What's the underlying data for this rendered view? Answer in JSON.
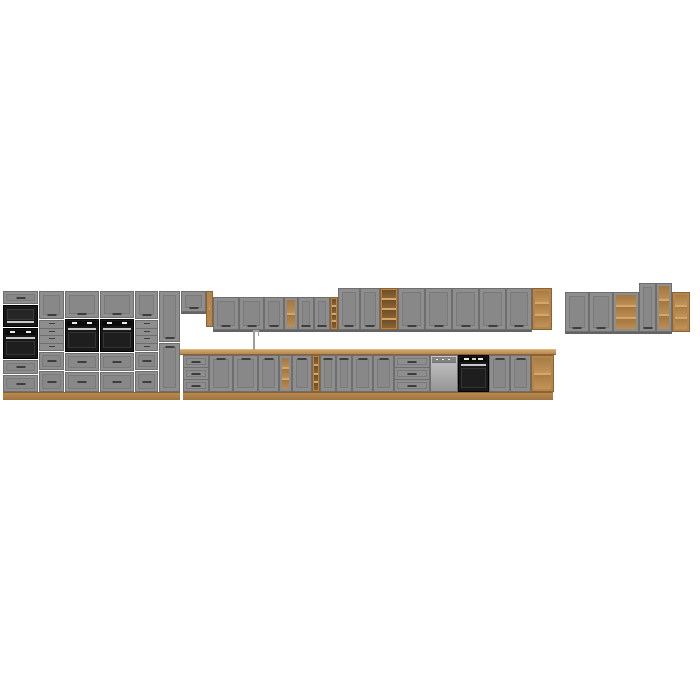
{
  "image": {
    "subject": "modular-kitchen-furniture-set-render",
    "background": "#ffffff",
    "front_style": "grey-shaker",
    "accent_material": "oak-wood"
  },
  "palette": {
    "door-gray": "#8e8e8e",
    "door-panel": "#888888",
    "door-frame": "#7a7a7a",
    "gap": "#6e6e6e",
    "carcass": "#646464",
    "handle": "#3e3e3e",
    "wood": "#b5854b",
    "wood-light": "#d4a768",
    "wood-dark": "#8a6233",
    "appliance-black": "#181818",
    "steel": "#c9c9c9"
  },
  "scene": {
    "width": 700,
    "height": 700,
    "modules": [
      {
        "name": "tall-column-top-drawer",
        "type": "drawer",
        "x": 3,
        "y": 291,
        "w": 35,
        "h": 13
      },
      {
        "name": "built-in-microwave",
        "type": "microwave",
        "x": 3,
        "y": 305,
        "w": 35,
        "h": 22
      },
      {
        "name": "built-in-oven-column",
        "type": "oven",
        "x": 3,
        "y": 328,
        "w": 35,
        "h": 31
      },
      {
        "name": "tall-column-drawer-2",
        "type": "drawer",
        "x": 3,
        "y": 360,
        "w": 35,
        "h": 14
      },
      {
        "name": "tall-column-drawer-3",
        "type": "drawer",
        "x": 3,
        "y": 375,
        "w": 35,
        "h": 17
      },
      {
        "name": "tall-cabinet-1-door",
        "type": "door",
        "handle": "bottom",
        "x": 39,
        "y": 291,
        "w": 25,
        "h": 28
      },
      {
        "name": "tall-cabinet-1-small-drawers",
        "type": "smalldrawers",
        "n": 4,
        "x": 39,
        "y": 320,
        "w": 25,
        "h": 31
      },
      {
        "name": "tall-cabinet-1-drawer-1",
        "type": "drawer",
        "x": 39,
        "y": 352,
        "w": 25,
        "h": 18
      },
      {
        "name": "tall-cabinet-1-drawer-2",
        "type": "drawer",
        "x": 39,
        "y": 371,
        "w": 25,
        "h": 21
      },
      {
        "name": "oven-housing-1-door",
        "type": "door",
        "handle": "bottom",
        "x": 65,
        "y": 291,
        "w": 34,
        "h": 27
      },
      {
        "name": "built-in-oven-1",
        "type": "oven",
        "x": 65,
        "y": 319,
        "w": 34,
        "h": 33
      },
      {
        "name": "oven-housing-1-drawer-1",
        "type": "drawer",
        "x": 65,
        "y": 353,
        "w": 34,
        "h": 18
      },
      {
        "name": "oven-housing-1-drawer-2",
        "type": "drawer",
        "x": 65,
        "y": 372,
        "w": 34,
        "h": 20
      },
      {
        "name": "oven-housing-2-door",
        "type": "door",
        "handle": "bottom",
        "x": 100,
        "y": 291,
        "w": 34,
        "h": 27
      },
      {
        "name": "built-in-oven-2",
        "type": "oven",
        "x": 100,
        "y": 319,
        "w": 34,
        "h": 33
      },
      {
        "name": "oven-housing-2-drawer-1",
        "type": "drawer",
        "x": 100,
        "y": 353,
        "w": 34,
        "h": 18
      },
      {
        "name": "oven-housing-2-drawer-2",
        "type": "drawer",
        "x": 100,
        "y": 372,
        "w": 34,
        "h": 20
      },
      {
        "name": "tall-cabinet-2-door",
        "type": "door",
        "handle": "bottom",
        "x": 135,
        "y": 291,
        "w": 23,
        "h": 28
      },
      {
        "name": "tall-cabinet-2-small-drawers",
        "type": "smalldrawers",
        "n": 4,
        "x": 135,
        "y": 320,
        "w": 23,
        "h": 31
      },
      {
        "name": "tall-cabinet-2-drawer-1",
        "type": "drawer",
        "x": 135,
        "y": 352,
        "w": 23,
        "h": 18
      },
      {
        "name": "tall-cabinet-2-drawer-2",
        "type": "drawer",
        "x": 135,
        "y": 371,
        "w": 23,
        "h": 21
      },
      {
        "name": "tall-cabinet-3-upper-door",
        "type": "door",
        "handle": "bottom",
        "x": 159,
        "y": 291,
        "w": 21,
        "h": 51
      },
      {
        "name": "tall-cabinet-3-lower-door",
        "type": "door",
        "handle": "top",
        "x": 159,
        "y": 343,
        "w": 21,
        "h": 49
      },
      {
        "name": "tall-section-plinth",
        "type": "wood",
        "variant": "plinth",
        "x": 3,
        "y": 392,
        "w": 177,
        "h": 8
      },
      {
        "name": "wall-cabinet-high",
        "type": "door",
        "handle": "bottom",
        "wall": true,
        "x": 181,
        "y": 291,
        "w": 25,
        "h": 21
      },
      {
        "name": "wall-open-side-shelf",
        "type": "woodshelf",
        "cells": 2,
        "x": 206,
        "y": 291,
        "w": 7,
        "h": 36
      },
      {
        "name": "wall-cabinet-1",
        "type": "door",
        "handle": "bottom",
        "wall": true,
        "x": 213,
        "y": 297,
        "w": 26,
        "h": 33
      },
      {
        "name": "wall-cabinet-2",
        "type": "door",
        "handle": "bottom",
        "wall": true,
        "x": 239,
        "y": 297,
        "w": 25,
        "h": 33
      },
      {
        "name": "wall-cabinet-3",
        "type": "door",
        "handle": "bottom",
        "wall": true,
        "x": 264,
        "y": 297,
        "w": 20,
        "h": 33
      },
      {
        "name": "wall-open-shelf",
        "type": "openshelf",
        "cells": 2,
        "wall": true,
        "x": 284,
        "y": 297,
        "w": 14,
        "h": 33
      },
      {
        "name": "wall-cabinet-4",
        "type": "door",
        "handle": "bottom",
        "wall": true,
        "x": 298,
        "y": 297,
        "w": 16,
        "h": 33
      },
      {
        "name": "wall-cabinet-5",
        "type": "door",
        "handle": "bottom",
        "wall": true,
        "x": 314,
        "y": 297,
        "w": 16,
        "h": 33
      },
      {
        "name": "wall-wine-rack",
        "type": "winerack",
        "cells": 4,
        "wall": true,
        "x": 330,
        "y": 297,
        "w": 8,
        "h": 33
      },
      {
        "name": "wall-tall-cabinet-1",
        "type": "door",
        "handle": "bottom",
        "wall": true,
        "x": 338,
        "y": 288,
        "w": 22,
        "h": 42
      },
      {
        "name": "wall-tall-cabinet-2",
        "type": "door",
        "handle": "bottom",
        "wall": true,
        "x": 360,
        "y": 288,
        "w": 20,
        "h": 42
      },
      {
        "name": "wall-tall-wine-rack",
        "type": "winerack",
        "cells": 4,
        "wall": true,
        "x": 380,
        "y": 288,
        "w": 18,
        "h": 42
      },
      {
        "name": "wall-tall-cabinet-3",
        "type": "door",
        "handle": "bottom",
        "wall": true,
        "x": 398,
        "y": 288,
        "w": 27,
        "h": 42
      },
      {
        "name": "wall-tall-cabinet-4",
        "type": "door",
        "handle": "bottom",
        "wall": true,
        "x": 425,
        "y": 288,
        "w": 27,
        "h": 42
      },
      {
        "name": "wall-tall-cabinet-5",
        "type": "door",
        "handle": "bottom",
        "wall": true,
        "x": 452,
        "y": 288,
        "w": 27,
        "h": 42
      },
      {
        "name": "wall-tall-cabinet-6",
        "type": "door",
        "handle": "bottom",
        "wall": true,
        "x": 479,
        "y": 288,
        "w": 27,
        "h": 42
      },
      {
        "name": "wall-tall-cabinet-7",
        "type": "door",
        "handle": "bottom",
        "wall": true,
        "x": 506,
        "y": 288,
        "w": 26,
        "h": 42
      },
      {
        "name": "wall-wood-end-shelf",
        "type": "woodshelf",
        "cells": 3,
        "x": 532,
        "y": 288,
        "w": 20,
        "h": 42
      },
      {
        "name": "countertop",
        "type": "wood",
        "variant": "top",
        "x": 180,
        "y": 349,
        "w": 376,
        "h": 6
      },
      {
        "name": "sink-faucet",
        "type": "faucet",
        "x": 251,
        "y": 330,
        "w": 9,
        "h": 19
      },
      {
        "name": "base-drawer-unit-1",
        "type": "drawers3",
        "x": 183,
        "y": 355,
        "w": 26,
        "h": 37
      },
      {
        "name": "base-cabinet-1",
        "type": "door",
        "handle": "top",
        "x": 209,
        "y": 355,
        "w": 24,
        "h": 37
      },
      {
        "name": "sink-base-cabinet",
        "type": "door",
        "handle": "top",
        "x": 233,
        "y": 355,
        "w": 25,
        "h": 37
      },
      {
        "name": "base-cabinet-2",
        "type": "door",
        "handle": "top",
        "x": 258,
        "y": 355,
        "w": 21,
        "h": 37
      },
      {
        "name": "base-open-shelf",
        "type": "openshelf",
        "cells": 3,
        "x": 279,
        "y": 355,
        "w": 13,
        "h": 37
      },
      {
        "name": "base-cabinet-3",
        "type": "door",
        "handle": "top",
        "x": 292,
        "y": 355,
        "w": 20,
        "h": 37
      },
      {
        "name": "base-wine-rack",
        "type": "winerack",
        "cells": 4,
        "x": 312,
        "y": 355,
        "w": 8,
        "h": 37
      },
      {
        "name": "base-cabinet-4",
        "type": "door",
        "handle": "top",
        "x": 320,
        "y": 355,
        "w": 16,
        "h": 37
      },
      {
        "name": "base-cabinet-5",
        "type": "door",
        "handle": "top",
        "x": 336,
        "y": 355,
        "w": 16,
        "h": 37
      },
      {
        "name": "base-cabinet-6",
        "type": "door",
        "handle": "top",
        "x": 352,
        "y": 355,
        "w": 21,
        "h": 37
      },
      {
        "name": "base-cabinet-7",
        "type": "door",
        "handle": "top",
        "x": 373,
        "y": 355,
        "w": 21,
        "h": 37
      },
      {
        "name": "base-drawer-unit-2",
        "type": "drawers3",
        "x": 394,
        "y": 355,
        "w": 36,
        "h": 37
      },
      {
        "name": "dishwasher",
        "type": "dishwasher",
        "x": 430,
        "y": 355,
        "w": 28,
        "h": 37
      },
      {
        "name": "built-in-oven-base",
        "type": "builtin",
        "x": 458,
        "y": 355,
        "w": 31,
        "h": 37
      },
      {
        "name": "base-cabinet-8",
        "type": "door",
        "handle": "top",
        "x": 489,
        "y": 355,
        "w": 21,
        "h": 37
      },
      {
        "name": "base-cabinet-9",
        "type": "door",
        "handle": "top",
        "x": 510,
        "y": 355,
        "w": 21,
        "h": 37
      },
      {
        "name": "base-wood-end-shelf",
        "type": "woodshelf",
        "cells": 2,
        "x": 531,
        "y": 355,
        "w": 23,
        "h": 37
      },
      {
        "name": "base-plinth",
        "type": "wood",
        "variant": "plinth",
        "x": 183,
        "y": 392,
        "w": 370,
        "h": 8
      },
      {
        "name": "right-wall-cabinet-1",
        "type": "door",
        "handle": "bottom",
        "wall": true,
        "x": 565,
        "y": 292,
        "w": 24,
        "h": 40
      },
      {
        "name": "right-wall-cabinet-2",
        "type": "door",
        "handle": "bottom",
        "wall": true,
        "x": 589,
        "y": 292,
        "w": 24,
        "h": 40
      },
      {
        "name": "right-wall-open-shelf",
        "type": "openshelf",
        "cells": 3,
        "wall": true,
        "x": 613,
        "y": 292,
        "w": 26,
        "h": 40
      },
      {
        "name": "right-wall-tall-door",
        "type": "door",
        "handle": "bottom",
        "wall": true,
        "x": 639,
        "y": 283,
        "w": 17,
        "h": 49
      },
      {
        "name": "right-wall-tall-open-shelf",
        "type": "openshelf",
        "cells": 3,
        "wall": true,
        "x": 656,
        "y": 283,
        "w": 16,
        "h": 49
      },
      {
        "name": "right-wall-wood-end-shelf",
        "type": "woodshelf",
        "cells": 3,
        "x": 672,
        "y": 292,
        "w": 18,
        "h": 40
      }
    ]
  }
}
